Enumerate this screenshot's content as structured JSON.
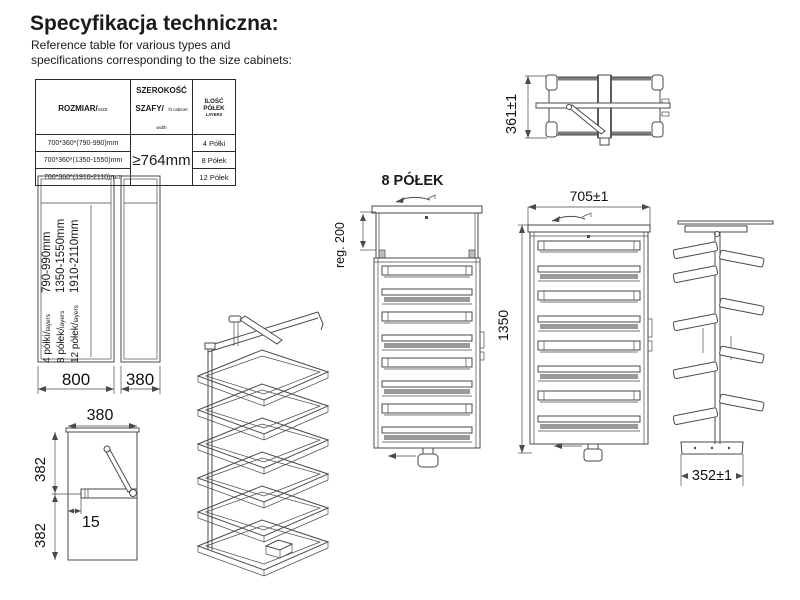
{
  "header": {
    "title": "Specyfikacja techniczna:",
    "subtitle1": "Reference table for various types and",
    "subtitle2": "specifications corresponding to the size cabinets:"
  },
  "table": {
    "headers": {
      "col1": "ROZMIAR/",
      "col1_small": "SIZE",
      "col2": "SZEROKOŚĆ SZAFY/",
      "col2_small": "fit cabinet width",
      "col3": "ILOŚĆ PÓŁEK",
      "col3_small": "LAYERS"
    },
    "merged_width": "≥764mm",
    "rows": [
      {
        "size": "700*360*(790-990)mm",
        "shelves": "4 Półki"
      },
      {
        "size": "700*360*(1350-1550)mm",
        "shelves": "8 Półek"
      },
      {
        "size": "700*360*(1910-2110)mm",
        "shelves": "12 Półek"
      }
    ]
  },
  "drawings": {
    "top_view": {
      "height_dim": "361±1"
    },
    "front_cabinets": {
      "width_wide": "800",
      "width_narrow": "380",
      "lines": [
        {
          "label": "4 półki/",
          "small": "layers",
          "range": "790-990mm"
        },
        {
          "label": "8 półek/",
          "small": "layers",
          "range": "1350-1550mm"
        },
        {
          "label": "12 półek/",
          "small": "layers",
          "range": "1910-2110mm"
        }
      ]
    },
    "plan_view": {
      "width": "380",
      "upper": "382",
      "lower": "382",
      "offset": "15"
    },
    "front_unit": {
      "title": "8 PÓŁEK",
      "reg": "reg. 200"
    },
    "side_unit": {
      "width": "705±1",
      "height": "1350"
    },
    "profile_unit": {
      "depth": "352±1"
    }
  }
}
